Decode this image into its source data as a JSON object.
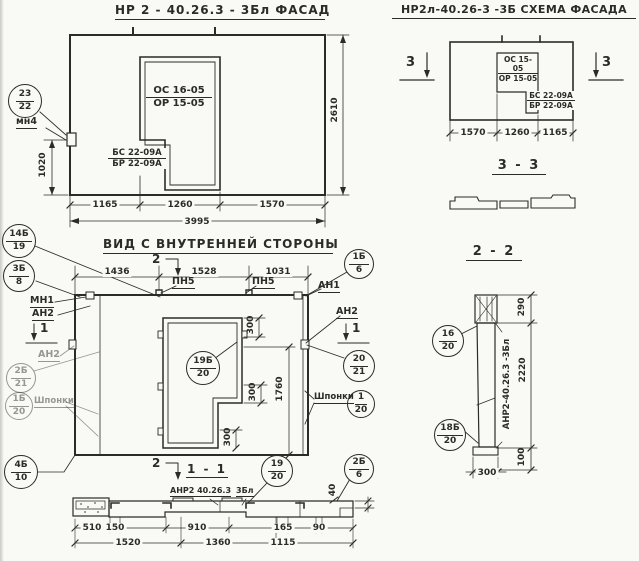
{
  "colors": {
    "ink": "#2b2b28",
    "paper": "#f9f9f6"
  },
  "titles": {
    "facade": "НР 2 - 40.26.3  - 3Бл  ФАСАД",
    "schema": "НР2л-40.26-3 -3Б  СХЕМА ФАСАДА",
    "inner": "ВИД С ВНУТРЕННЕЙ СТОРОНЫ",
    "s33": "3 - 3",
    "s22": "2 - 2",
    "s11": "1 - 1"
  },
  "facade": {
    "win_top": "ОС 16-05",
    "win_bot": "ОР 15-05",
    "jamb_top": "БС 22-09А",
    "jamb_bot": "БР 22-09А",
    "height": "2610",
    "left_height": "1020",
    "d1": "1165",
    "d2": "1260",
    "d3": "1570",
    "total": "3995",
    "c23": {
      "t": "23",
      "b": "22"
    },
    "mn4": "мн4"
  },
  "schema": {
    "win_top": "ОС 15-05",
    "win_bot": "ОР 15-05",
    "jamb_top": "БС 22-09А",
    "jamb_bot": "БР 22-09А",
    "d1": "1570",
    "d2": "1260",
    "d3": "1165",
    "cut": "3"
  },
  "inner": {
    "d1": "1436",
    "d2": "1528",
    "d3": "1031",
    "pn5": "ПН5",
    "an1": "АН1",
    "an2": "АН2",
    "mn1": "МН1",
    "cut1": "1",
    "cut2": "2",
    "shponki": "Шпонки",
    "d300": "300",
    "d1760": "1760",
    "c14b19": {
      "t": "14Б",
      "b": "19"
    },
    "c3b8": {
      "t": "3Б",
      "b": "8"
    },
    "c1b6": {
      "t": "1Б",
      "b": "6"
    },
    "c2b21": {
      "t": "2Б",
      "b": "21"
    },
    "c1b20": {
      "t": "1Б",
      "b": "20"
    },
    "c4b10": {
      "t": "4Б",
      "b": "10"
    },
    "c20_21": {
      "t": "20",
      "b": "21"
    },
    "c1_20": {
      "t": "1",
      "b": "20"
    },
    "c19b20": {
      "t": "19Б",
      "b": "20"
    }
  },
  "s11": {
    "mark": "АНР2 40.26.3",
    "mark2": "3Бл",
    "c19_20": {
      "t": "19",
      "b": "20"
    },
    "c2b6": {
      "t": "2Б",
      "b": "6"
    },
    "d40": "40",
    "r1": [
      "510",
      "150",
      "910",
      "165",
      "90"
    ],
    "r2": [
      "1520",
      "1360",
      "1115"
    ]
  },
  "s22": {
    "mark": "АНР2-40.26.3 -3Бл",
    "c16_20": {
      "t": "16",
      "b": "20"
    },
    "c18b20": {
      "t": "18Б",
      "b": "20"
    },
    "d290": "290",
    "d2220": "2220",
    "d100": "100",
    "d300": "300"
  }
}
